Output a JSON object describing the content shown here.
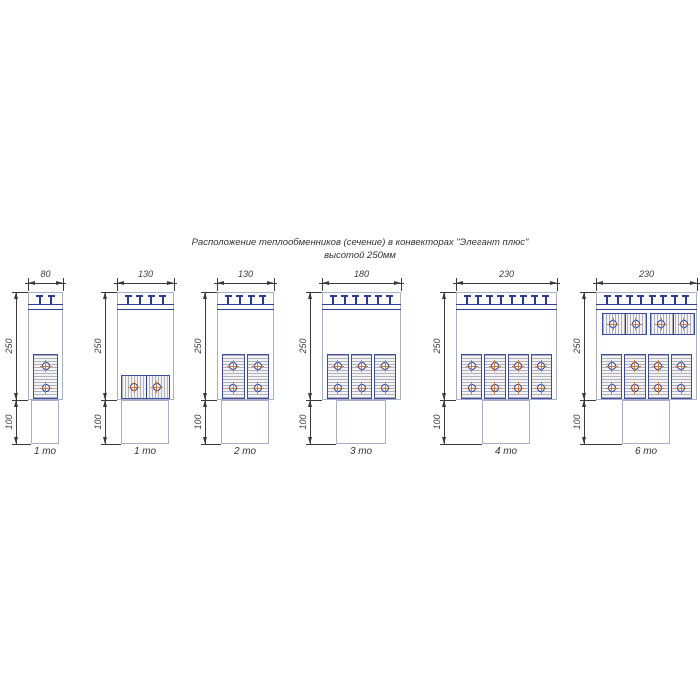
{
  "title": {
    "line1": "Расположение теплообменников (сечение) в конвекторах \"Элегант плюс\"",
    "line2": "высотой 250мм"
  },
  "colors": {
    "outline": "#a6b0cc",
    "detail": "#2e3b94",
    "block_border": "#3d4ba3",
    "block_bg": "#f3f3f5",
    "hatch": "#7d7d8a",
    "tube_cross": "#c9783a",
    "dimension": "#3a3a3a",
    "text": "#333333"
  },
  "common": {
    "height_label": "250",
    "duct_label": "100"
  },
  "diagrams": [
    {
      "width_label": "80",
      "label": "1 то",
      "width_mm": 80,
      "cx": 45,
      "slats": 2,
      "vertical_blocks": 1,
      "horizontal_bottom_blocks": 0,
      "horizontal_top_blocks": 0,
      "duct_w": 28
    },
    {
      "width_label": "130",
      "label": "1 то",
      "width_mm": 130,
      "cx": 145,
      "slats": 4,
      "vertical_blocks": 0,
      "horizontal_bottom_blocks": 1,
      "horizontal_top_blocks": 0,
      "duct_w": 48
    },
    {
      "width_label": "130",
      "label": "2 то",
      "width_mm": 130,
      "cx": 245,
      "slats": 4,
      "vertical_blocks": 2,
      "horizontal_bottom_blocks": 0,
      "horizontal_top_blocks": 0,
      "duct_w": 48
    },
    {
      "width_label": "180",
      "label": "3 то",
      "width_mm": 180,
      "cx": 361,
      "slats": 6,
      "vertical_blocks": 3,
      "horizontal_bottom_blocks": 0,
      "horizontal_top_blocks": 0,
      "duct_w": 50
    },
    {
      "width_label": "230",
      "label": "4 то",
      "width_mm": 230,
      "cx": 506,
      "slats": 8,
      "vertical_blocks": 4,
      "horizontal_bottom_blocks": 0,
      "horizontal_top_blocks": 0,
      "duct_w": 48
    },
    {
      "width_label": "230",
      "label": "6 то",
      "width_mm": 230,
      "cx": 646,
      "slats": 8,
      "vertical_blocks": 4,
      "horizontal_bottom_blocks": 0,
      "horizontal_top_blocks": 2,
      "duct_w": 48
    }
  ]
}
